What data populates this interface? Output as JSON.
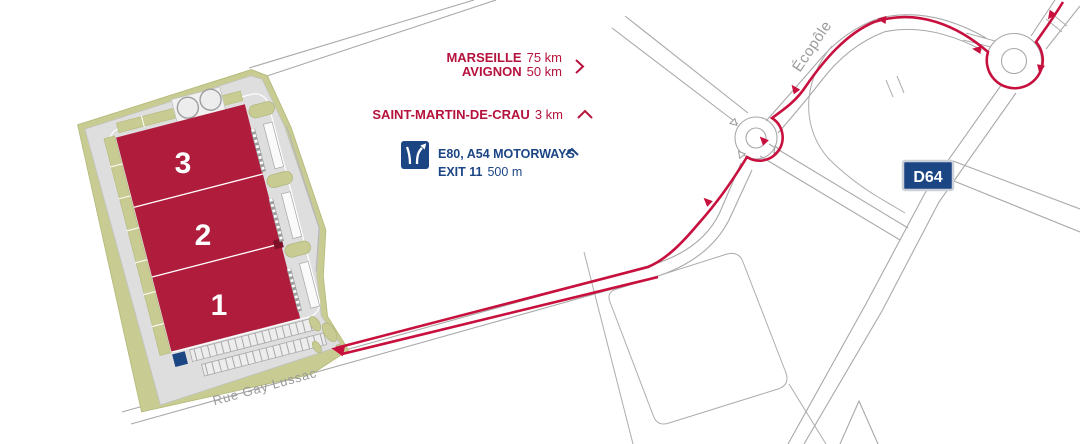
{
  "map": {
    "type": "site-access-map",
    "destinations": {
      "marseille": {
        "name": "MARSEILLE",
        "distance": "75 km"
      },
      "avignon": {
        "name": "AVIGNON",
        "distance": "50 km"
      },
      "saint_martin": {
        "name": "SAINT-MARTIN-DE-CRAU",
        "distance": "3 km"
      }
    },
    "motorway": {
      "title": "E80, A54 MOTORWAYS",
      "exit": "EXIT 11",
      "distance": "500 m"
    },
    "roads": {
      "d64_badge": "D64",
      "ecopole": "Écopôle",
      "street": "Rue Gay Lussac"
    },
    "buildings": {
      "b1": "1",
      "b2": "2",
      "b3": "3"
    },
    "colors": {
      "brand_red": "#b5123c",
      "route_red": "#c8103e",
      "navy": "#1c4584",
      "site_green": "#c8cc92",
      "pavement_gray": "#dedede",
      "road_gray": "#a9a9a9"
    }
  }
}
